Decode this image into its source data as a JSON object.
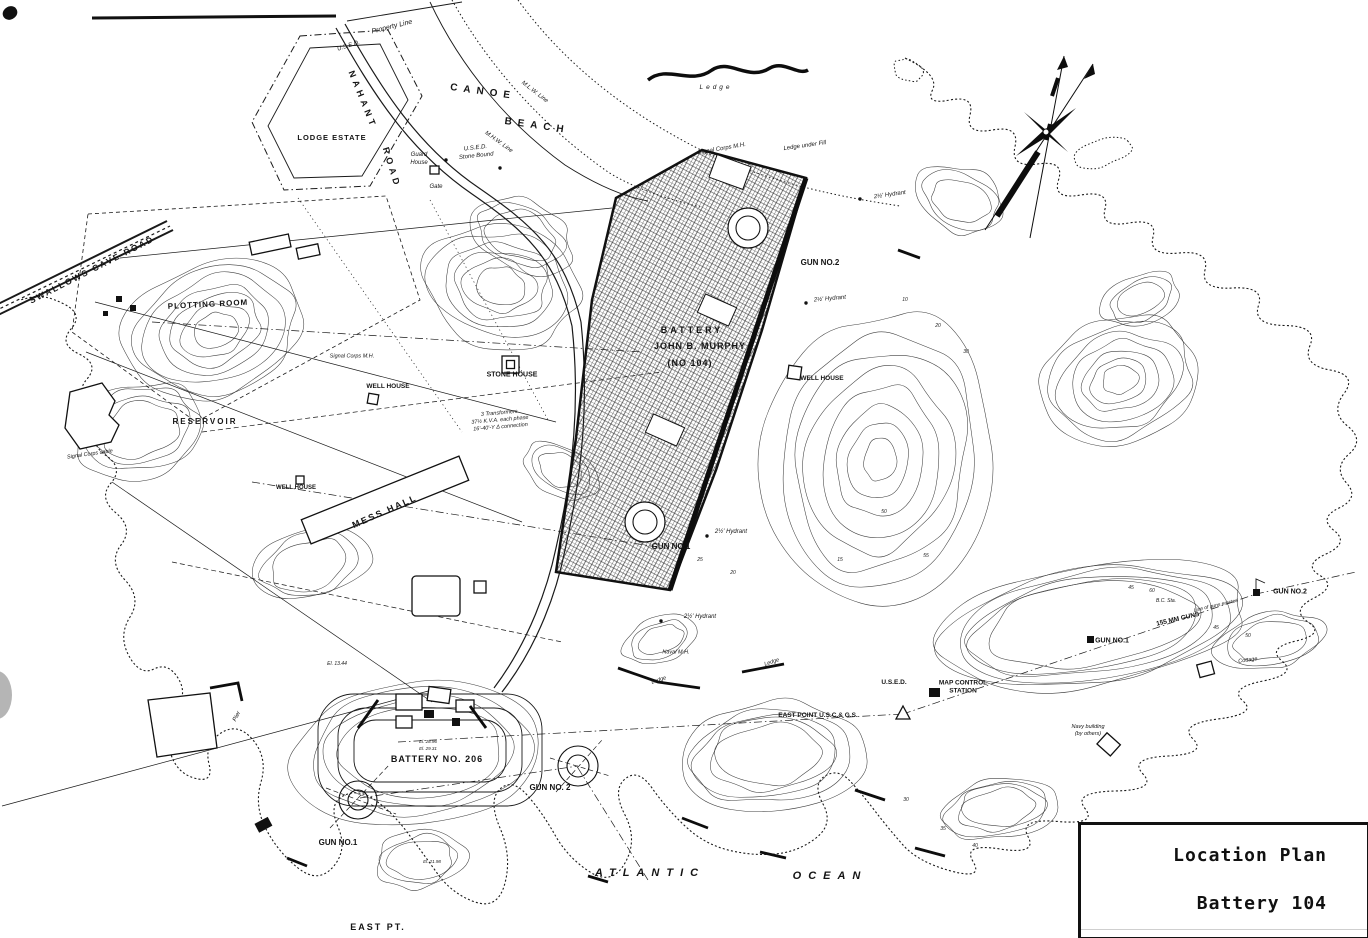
{
  "title_block": {
    "line1": "Location Plan",
    "line2": "Battery 104"
  },
  "ink_color": "#141414",
  "paper_color": "#ffffff",
  "labels": [
    {
      "id": "property-line",
      "t": "Property Line",
      "x": 392,
      "y": 27,
      "r": -14,
      "s": 7,
      "i": 1
    },
    {
      "id": "used-top",
      "t": "U.S.E.D.",
      "x": 349,
      "y": 47,
      "r": -18,
      "s": 6,
      "i": 1
    },
    {
      "id": "nahant",
      "t": "NAHANT",
      "x": 362,
      "y": 100,
      "r": 68,
      "s": 9,
      "sp": 4,
      "b": 1
    },
    {
      "id": "nahant-road",
      "t": "ROAD",
      "x": 391,
      "y": 168,
      "r": 73,
      "s": 9,
      "sp": 4,
      "b": 1
    },
    {
      "id": "canoe",
      "t": "CANOE",
      "x": 483,
      "y": 92,
      "r": 8,
      "s": 10,
      "sp": 6,
      "b": 1
    },
    {
      "id": "beach",
      "t": "BEACH",
      "x": 537,
      "y": 126,
      "r": 8,
      "s": 10,
      "sp": 6,
      "b": 1
    },
    {
      "id": "lodge-estate",
      "t": "LODGE ESTATE",
      "x": 332,
      "y": 138,
      "r": 0,
      "s": 7.5,
      "sp": 1,
      "b": 1
    },
    {
      "id": "guard-house",
      "t": "Guard\nHouse",
      "x": 419,
      "y": 160,
      "r": 0,
      "s": 6,
      "i": 1
    },
    {
      "id": "stone-bound",
      "t": "U.S.E.D.\nStone Bound",
      "x": 476,
      "y": 153,
      "r": -6,
      "s": 6,
      "i": 1
    },
    {
      "id": "gate",
      "t": "Gate",
      "x": 436,
      "y": 188,
      "r": 0,
      "s": 6,
      "i": 1
    },
    {
      "id": "mlw-line",
      "t": "M.L.W. Line",
      "x": 534,
      "y": 93,
      "r": 38,
      "s": 6,
      "i": 1
    },
    {
      "id": "mhw-line",
      "t": "M.H.W. Line",
      "x": 498,
      "y": 143,
      "r": 36,
      "s": 6,
      "i": 1
    },
    {
      "id": "ledge-top",
      "t": "Ledge",
      "x": 716,
      "y": 88,
      "r": 0,
      "s": 6.5,
      "sp": 3,
      "i": 1
    },
    {
      "id": "signal-corps-mh-top",
      "t": "Signal Corps M.H.",
      "x": 722,
      "y": 150,
      "r": -10,
      "s": 6,
      "i": 1
    },
    {
      "id": "ledge-under-fill",
      "t": "Ledge under Fill",
      "x": 805,
      "y": 147,
      "r": -8,
      "s": 6,
      "i": 1
    },
    {
      "id": "hydrant-ne",
      "t": "2½' Hydrant",
      "x": 890,
      "y": 196,
      "r": -8,
      "s": 6,
      "i": 1
    },
    {
      "id": "hydrant-e",
      "t": "2½' Hydrant",
      "x": 830,
      "y": 300,
      "r": -5,
      "s": 6,
      "i": 1
    },
    {
      "id": "swallows-cave-road",
      "t": "SWALLOWS CAVE ROAD",
      "x": 92,
      "y": 270,
      "r": -27,
      "s": 8.5,
      "sp": 2,
      "b": 1
    },
    {
      "id": "plotting-room",
      "t": "PLOTTING ROOM",
      "x": 208,
      "y": 305,
      "r": -3,
      "s": 8,
      "sp": 1,
      "b": 1
    },
    {
      "id": "reservoir",
      "t": "RESERVOIR",
      "x": 205,
      "y": 422,
      "r": 0,
      "s": 8,
      "sp": 2,
      "b": 1
    },
    {
      "id": "signal-corps-cable",
      "t": "Signal Corps cable",
      "x": 90,
      "y": 455,
      "r": -8,
      "s": 5.5,
      "i": 1
    },
    {
      "id": "signal-corps-mh-w",
      "t": "Signal Corps M.H.",
      "x": 352,
      "y": 357,
      "r": 0,
      "s": 5.5,
      "i": 1
    },
    {
      "id": "well-house-w",
      "t": "WELL HOUSE",
      "x": 388,
      "y": 387,
      "r": 0,
      "s": 6.5,
      "b": 1
    },
    {
      "id": "stone-house",
      "t": "STONE HOUSE",
      "x": 512,
      "y": 375,
      "r": 0,
      "s": 7,
      "b": 1
    },
    {
      "id": "transformers-note",
      "t": "3 Transformers\n37½ K.V.A. each phase\n16'-40'-Y Δ connection",
      "x": 500,
      "y": 421,
      "r": -5,
      "s": 5.5,
      "i": 1
    },
    {
      "id": "battery-name-1",
      "t": "BATTERY",
      "x": 692,
      "y": 331,
      "r": 0,
      "s": 9,
      "sp": 3,
      "b": 1
    },
    {
      "id": "battery-name-2",
      "t": "JOHN B. MURPHY",
      "x": 700,
      "y": 347,
      "r": 0,
      "s": 9,
      "sp": 1,
      "b": 1
    },
    {
      "id": "battery-name-3",
      "t": "(NO 104)",
      "x": 690,
      "y": 364,
      "r": 0,
      "s": 9,
      "sp": 1,
      "b": 1
    },
    {
      "id": "well-house-e",
      "t": "WELL HOUSE",
      "x": 822,
      "y": 379,
      "r": 0,
      "s": 6.5,
      "b": 1
    },
    {
      "id": "gun-no2-battery",
      "t": "GUN NO.2",
      "x": 820,
      "y": 263,
      "r": 0,
      "s": 8,
      "b": 1
    },
    {
      "id": "gun-no1-battery",
      "t": "GUN NO.1",
      "x": 671,
      "y": 547,
      "r": 0,
      "s": 8,
      "b": 1
    },
    {
      "id": "hydrant-gun1",
      "t": "2½' Hydrant",
      "x": 731,
      "y": 533,
      "r": 0,
      "s": 6,
      "i": 1
    },
    {
      "id": "hydrant-s",
      "t": "2½' Hydrant",
      "x": 700,
      "y": 618,
      "r": 0,
      "s": 6,
      "i": 1
    },
    {
      "id": "mess-hall",
      "t": "MESS HALL",
      "x": 385,
      "y": 512,
      "r": -24,
      "s": 9,
      "sp": 2,
      "b": 1
    },
    {
      "id": "well-house-m",
      "t": "WELL HOUSE",
      "x": 296,
      "y": 489,
      "r": 0,
      "s": 6,
      "b": 1
    },
    {
      "id": "naval-mh",
      "t": "Naval M.H.",
      "x": 676,
      "y": 653,
      "r": 0,
      "s": 5.5,
      "i": 1
    },
    {
      "id": "ledge-s1",
      "t": "Ledge",
      "x": 659,
      "y": 681,
      "r": -18,
      "s": 5.5,
      "i": 1
    },
    {
      "id": "ledge-s2",
      "t": "Ledge",
      "x": 772,
      "y": 663,
      "r": -18,
      "s": 5.5,
      "i": 1
    },
    {
      "id": "used-east",
      "t": "U.S.E.D.",
      "x": 894,
      "y": 683,
      "r": 0,
      "s": 6.5,
      "b": 1
    },
    {
      "id": "map-control-station",
      "t": "MAP CONTROL\nSTATION",
      "x": 963,
      "y": 688,
      "r": 0,
      "s": 6.5,
      "b": 1
    },
    {
      "id": "east-point-uscgs",
      "t": "EAST POINT U.S.C.& G.S.",
      "x": 818,
      "y": 716,
      "r": 0,
      "s": 6.5,
      "b": 1
    },
    {
      "id": "navy-building",
      "t": "Navy building\n(by others)",
      "x": 1088,
      "y": 731,
      "r": 0,
      "s": 5.5,
      "i": 1
    },
    {
      "id": "gun-no2-east",
      "t": "GUN NO.2",
      "x": 1290,
      "y": 592,
      "r": 0,
      "s": 7,
      "b": 1
    },
    {
      "id": "gun-no1-east",
      "t": "GUN NO.1",
      "x": 1112,
      "y": 641,
      "r": 0,
      "s": 7,
      "b": 1
    },
    {
      "id": "bc-sta",
      "t": "B.C. Sta.",
      "x": 1166,
      "y": 601,
      "r": 0,
      "s": 5,
      "i": 1
    },
    {
      "id": "line-of-guns",
      "t": "Line of guns erected",
      "x": 1216,
      "y": 606,
      "r": -13,
      "s": 5,
      "i": 1
    },
    {
      "id": "guns-155mm",
      "t": "155 MM GUNS",
      "x": 1178,
      "y": 620,
      "r": -13,
      "s": 6.5,
      "b": 1
    },
    {
      "id": "cottage",
      "t": "Cottage",
      "x": 1248,
      "y": 661,
      "r": -8,
      "s": 5.5,
      "i": 1
    },
    {
      "id": "battery-206",
      "t": "BATTERY NO. 206",
      "x": 437,
      "y": 760,
      "r": 0,
      "s": 9,
      "sp": 1,
      "b": 1
    },
    {
      "id": "gun-no2-206",
      "t": "GUN NO. 2",
      "x": 550,
      "y": 788,
      "r": 0,
      "s": 8,
      "b": 1
    },
    {
      "id": "gun-no1-206",
      "t": "GUN NO.1",
      "x": 338,
      "y": 843,
      "r": 0,
      "s": 8,
      "b": 1
    },
    {
      "id": "east-pt",
      "t": "EAST PT.",
      "x": 378,
      "y": 928,
      "r": 0,
      "s": 9,
      "sp": 2,
      "b": 1
    },
    {
      "id": "atlantic",
      "t": "ATLANTIC",
      "x": 650,
      "y": 873,
      "r": 0,
      "s": 11,
      "sp": 7,
      "i": 1,
      "b": 1
    },
    {
      "id": "ocean",
      "t": "OCEAN",
      "x": 830,
      "y": 876,
      "r": 0,
      "s": 11,
      "sp": 7,
      "i": 1,
      "b": 1
    },
    {
      "id": "pier",
      "t": "Pier",
      "x": 238,
      "y": 717,
      "r": -62,
      "s": 6,
      "i": 1
    },
    {
      "id": "el-1344",
      "t": "El. 13.44",
      "x": 337,
      "y": 664,
      "r": 0,
      "s": 5,
      "i": 1
    },
    {
      "id": "el-2896",
      "t": "El. 28.96",
      "x": 428,
      "y": 742,
      "r": 0,
      "s": 4.5,
      "i": 1
    },
    {
      "id": "el-2931",
      "t": "El. 29.31",
      "x": 428,
      "y": 749,
      "r": 0,
      "s": 4.5,
      "i": 1
    },
    {
      "id": "el-2198",
      "t": "El. 21.98",
      "x": 432,
      "y": 862,
      "r": 0,
      "s": 4.5,
      "i": 1
    }
  ],
  "contour_elevations": [
    {
      "t": "60",
      "x": 1152,
      "y": 591
    },
    {
      "t": "55",
      "x": 926,
      "y": 556
    },
    {
      "t": "50",
      "x": 884,
      "y": 512
    },
    {
      "t": "45",
      "x": 1131,
      "y": 588
    },
    {
      "t": "40",
      "x": 975,
      "y": 846
    },
    {
      "t": "35",
      "x": 943,
      "y": 829
    },
    {
      "t": "30",
      "x": 906,
      "y": 800
    },
    {
      "t": "50",
      "x": 1248,
      "y": 636
    },
    {
      "t": "45",
      "x": 1216,
      "y": 628
    },
    {
      "t": "25",
      "x": 700,
      "y": 560
    },
    {
      "t": "20",
      "x": 733,
      "y": 573
    },
    {
      "t": "15",
      "x": 840,
      "y": 560
    },
    {
      "t": "10",
      "x": 905,
      "y": 300
    },
    {
      "t": "20",
      "x": 938,
      "y": 326
    },
    {
      "t": "30",
      "x": 966,
      "y": 352
    }
  ]
}
